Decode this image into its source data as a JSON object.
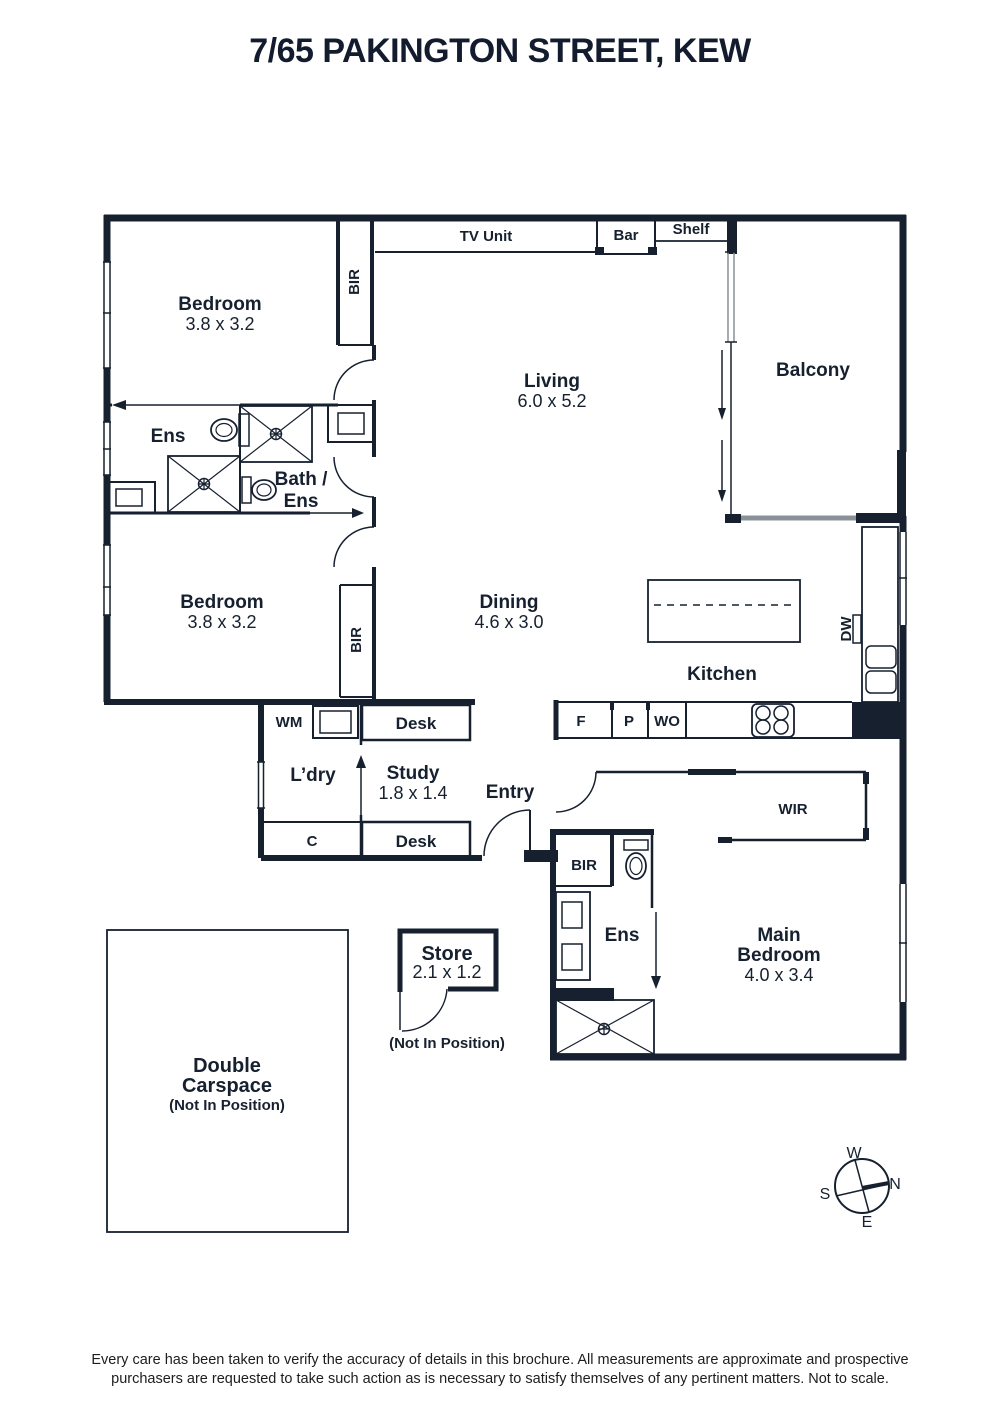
{
  "title": "7/65 PAKINGTON STREET, KEW",
  "rooms": {
    "bedroom1": {
      "name": "Bedroom",
      "size": "3.8 x 3.2"
    },
    "bedroom2": {
      "name": "Bedroom",
      "size": "3.8 x 3.2"
    },
    "ens1": {
      "name": "Ens"
    },
    "bath_ens": {
      "line1": "Bath /",
      "line2": "Ens"
    },
    "living": {
      "name": "Living",
      "size": "6.0 x 5.2"
    },
    "dining": {
      "name": "Dining",
      "size": "4.6 x 3.0"
    },
    "kitchen": {
      "name": "Kitchen"
    },
    "balcony": {
      "name": "Balcony"
    },
    "laundry": {
      "name": "L’dry"
    },
    "study": {
      "name": "Study",
      "size": "1.8 x 1.4"
    },
    "entry": {
      "name": "Entry"
    },
    "wir": {
      "name": "WIR"
    },
    "ens2": {
      "name": "Ens"
    },
    "main_bedroom": {
      "line1": "Main",
      "line2": "Bedroom",
      "size": "4.0 x 3.4"
    },
    "store": {
      "name": "Store",
      "size": "2.1 x 1.2",
      "note": "(Not In Position)"
    },
    "carspace": {
      "line1": "Double",
      "line2": "Carspace",
      "note": "(Not In Position)"
    }
  },
  "fixtures": {
    "tv_unit": "TV Unit",
    "bar": "Bar",
    "shelf": "Shelf",
    "bir_bedroom1": "BIR",
    "bir_bedroom2": "BIR",
    "bir_main": "BIR",
    "washing_machine": "WM",
    "cupboard": "C",
    "desk_top": "Desk",
    "desk_bottom": "Desk",
    "fridge": "F",
    "pantry": "P",
    "wall_oven": "WO",
    "dishwasher": "DW"
  },
  "compass": {
    "north": "N",
    "south": "S",
    "east": "E",
    "west": "W"
  },
  "disclaimer": {
    "line1": "Every care has been taken to verify the accuracy of details in this brochure. All measurements are approximate and prospective",
    "line2": "purchasers are requested to take such action as is necessary to satisfy themselves of any pertinent matters. Not to scale."
  },
  "colors": {
    "ink": "#16202f",
    "track_gray": "#8b9198"
  }
}
